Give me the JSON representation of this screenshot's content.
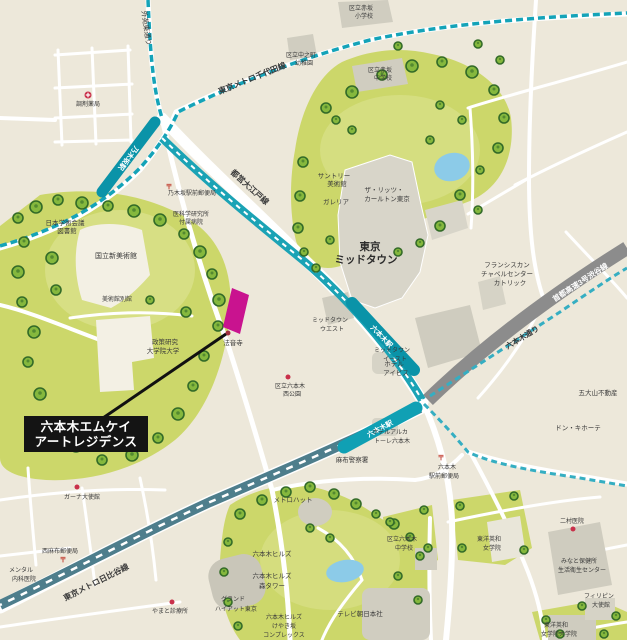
{
  "property": {
    "name_line1": "六本木エムケイ",
    "name_line2": "アートレジデンス",
    "marker_color": "#c9138f",
    "label_bg": "#141414"
  },
  "transit": {
    "chiyoda_line": "東京メトロ千代田線",
    "oedo_line": "都営大江戸線",
    "hibiya_line": "東京メトロ日比谷線",
    "expressway": "首都高速3号渋谷線",
    "road_gaien_higashi": "外苑東通り",
    "road_roppongi_dori": "六本木通り",
    "station_nogizaka": "乃木坂駅",
    "station_roppongi_oedo": "六本木駅",
    "station_roppongi_hibiya": "六本木駅",
    "line_color": "#14a3b8",
    "expressway_color": "#8c8c8c"
  },
  "places": {
    "akasaka_es_l1": "区立赤坂",
    "akasaka_es_l2": "小学校",
    "nakanocho_l1": "区立中之町",
    "nakanocho_l2": "幼稚園",
    "akasaka_jhs_l1": "区立赤坂",
    "akasaka_jhs_l2": "中学校",
    "pharmacy": "調剤薬局",
    "nogizaka_post": "乃木坂駅前郵便局",
    "research_hosp_l1": "医科学研究所",
    "research_hosp_l2": "付属病院",
    "science_council_l1": "日本学術会議",
    "science_council_l2": "図書館",
    "art_center": "国立新美術館",
    "art_center_annex": "美術館別館",
    "grips_l1": "政策研究",
    "grips_l2": "大学院大学",
    "honoji": "法音寺",
    "nishi_park_l1": "区立六本木",
    "nishi_park_l2": "西公園",
    "suntory_l1": "サントリー",
    "suntory_l2": "美術館",
    "ritz_l1": "ザ・リッツ・",
    "ritz_l2": "カールトン東京",
    "galleria": "ガレリア",
    "midtown_l1": "東京",
    "midtown_l2": "ミッドタウン",
    "midtown_west_l1": "ミッドタウン",
    "midtown_west_l2": "ウエスト",
    "midtown_east_l1": "ミッドタウン",
    "midtown_east_l2": "イースト",
    "franciscan_l1": "フランシスカン",
    "franciscan_l2": "チャペルセンター",
    "franciscan_l3": "カトリック",
    "godaisan": "五大山不動産",
    "donki": "ドン・キホーテ",
    "hotel_ibis_l1": "ホテル",
    "hotel_ibis_l2": "アイビス",
    "hotel_arca_l1": "ホテルアルカ",
    "hotel_arca_l2": "トーレ六本木",
    "azabu_police": "麻布警察署",
    "roppongi_post_l1": "六本木",
    "roppongi_post_l2": "駅前郵便局",
    "nimura": "二村医院",
    "toyo_eiwa_l1": "東洋英和",
    "toyo_eiwa_l2": "女学院",
    "minato_hoken_l1": "みなと保健所",
    "minato_hoken_l2": "生活衛生センター",
    "philippines_l1": "フィリピン",
    "philippines_l2": "大使館",
    "eiwa_grad_l1": "東洋英和",
    "eiwa_grad_l2": "女学院大学院",
    "ghana": "ガーナ大使館",
    "nishiazabu_post": "西麻布郵便局",
    "mental_l1": "メンタル",
    "mental_l2": "内科医院",
    "yamato_clinic": "やまと診療所",
    "metro_hat": "メトロハット",
    "hills": "六本木ヒルズ",
    "mori_l1": "六本木ヒルズ",
    "mori_l2": "森タワー",
    "hyatt_l1": "グランド",
    "hyatt_l2": "ハイアット東京",
    "keyaki_l1": "六本木ヒルズ",
    "keyaki_l2": "けやき坂",
    "keyaki_l3": "コンプレックス",
    "tv_asahi": "テレビ朝日本社",
    "roppongi_jhs_l1": "区立六本木",
    "roppongi_jhs_l2": "中学校",
    "post_mark": "〒"
  },
  "colors": {
    "background": "#ede8da",
    "park_green": "#ccd76a",
    "pond_blue": "#8ccbe8",
    "building_gray": "#d7d4c7",
    "poi_red": "#c9304a"
  }
}
